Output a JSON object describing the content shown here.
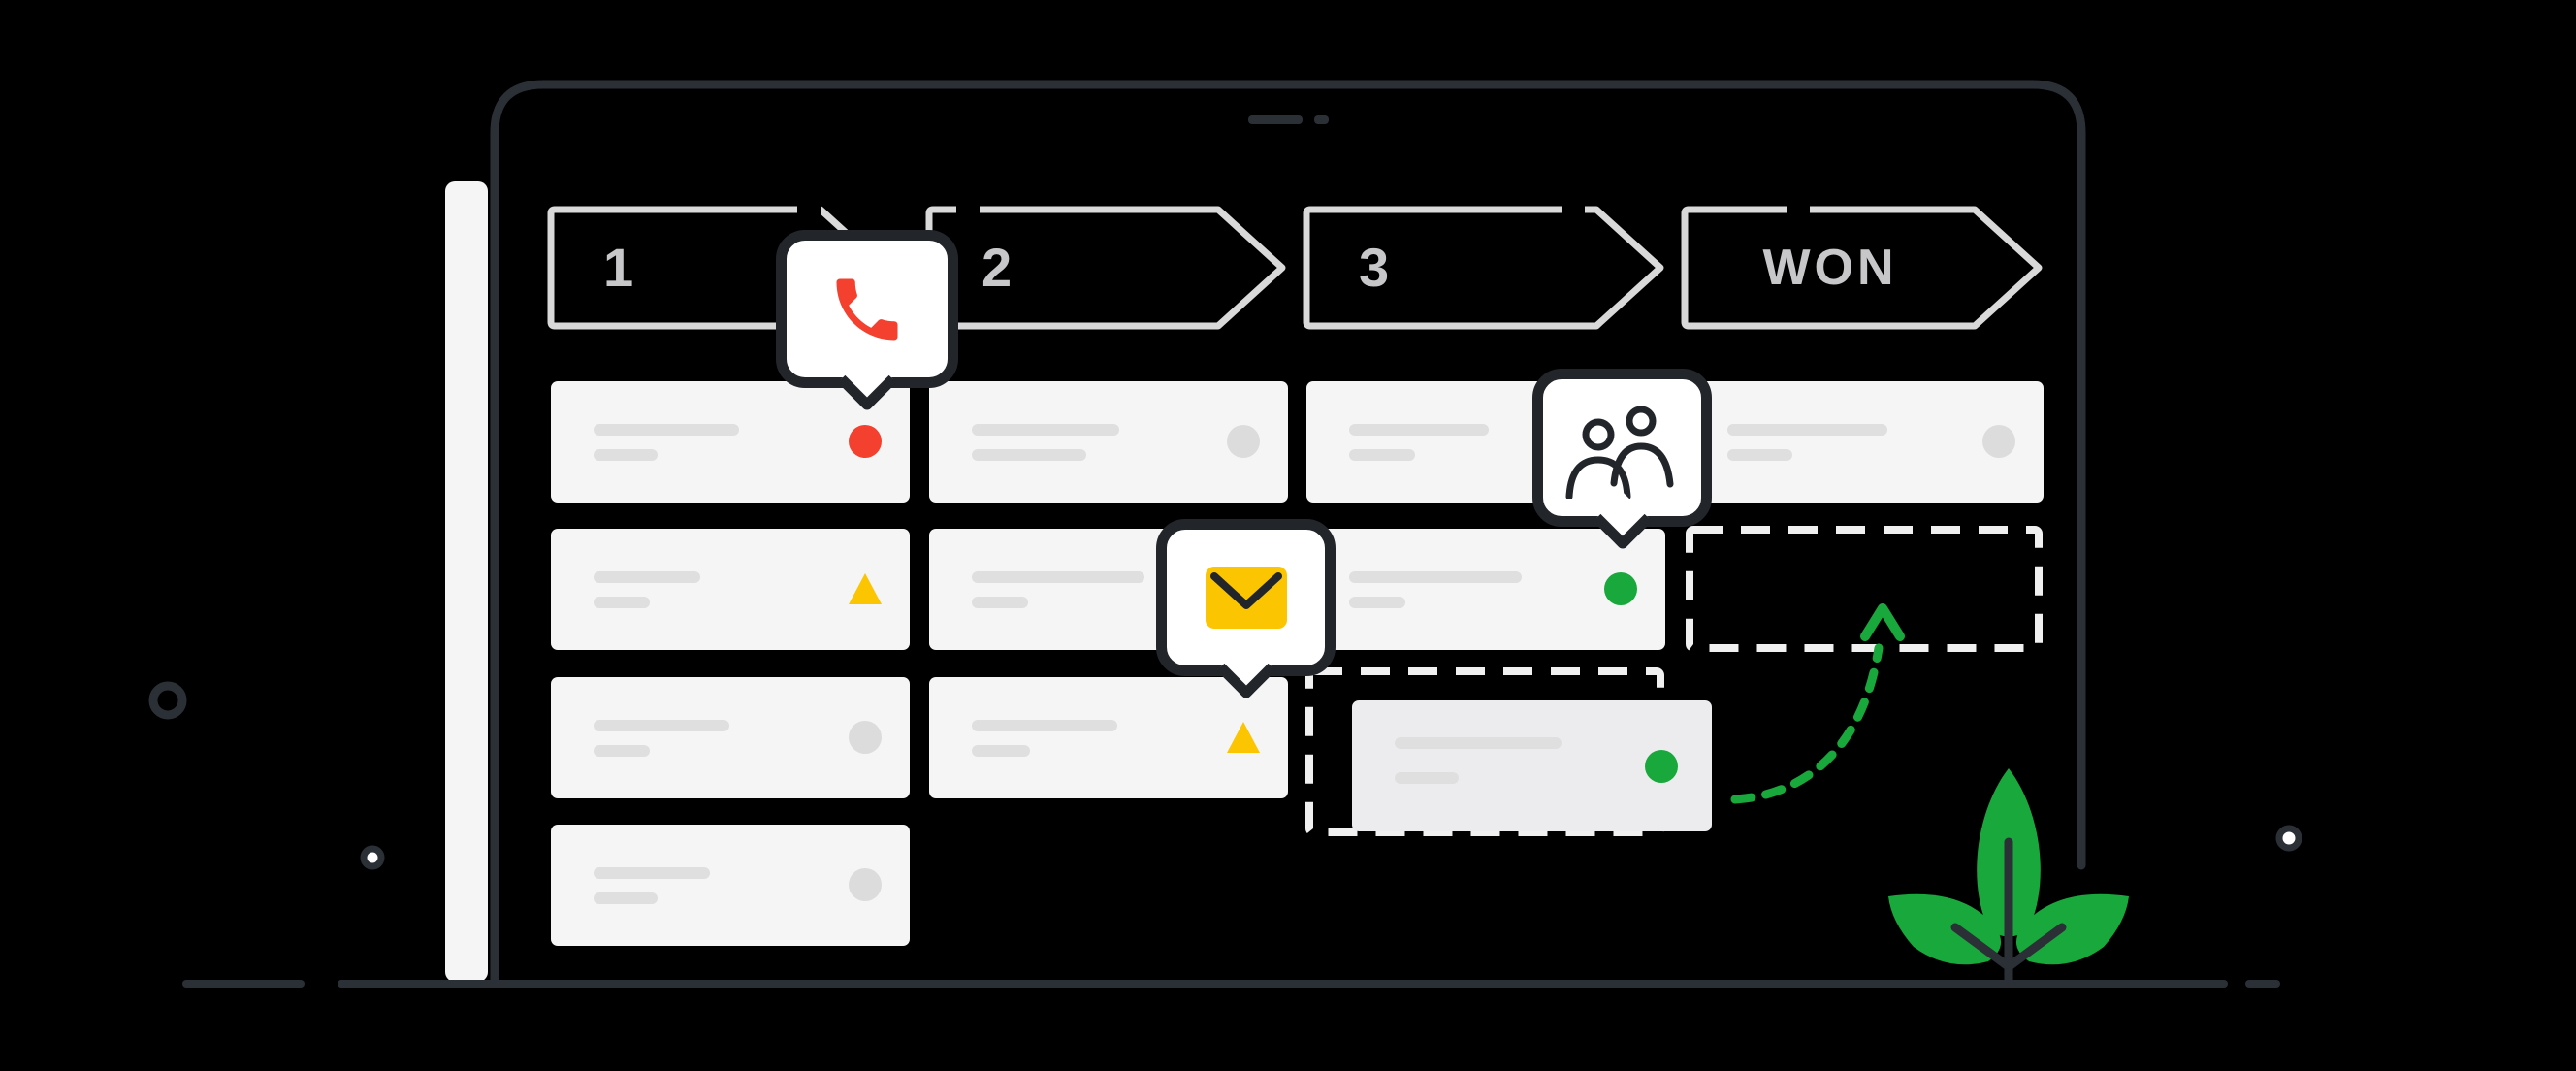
{
  "scene": {
    "description": "Sales pipeline kanban illustration on a laptop screen with a deal card being dragged to the WON stage"
  },
  "pipeline": {
    "stages": [
      {
        "label": "1"
      },
      {
        "label": "2"
      },
      {
        "label": "3"
      },
      {
        "label": "WON"
      }
    ]
  },
  "board": {
    "columns": [
      {
        "stage": "1",
        "cards": [
          {
            "row": 1,
            "indicator": "red-dot",
            "line1": 150,
            "line2": 66
          },
          {
            "row": 2,
            "indicator": "yellow-triangle",
            "line1": 110,
            "line2": 58
          },
          {
            "row": 3,
            "indicator": "gray-dot",
            "line1": 140,
            "line2": 58
          },
          {
            "row": 4,
            "indicator": "gray-dot",
            "line1": 120,
            "line2": 66
          }
        ]
      },
      {
        "stage": "2",
        "cards": [
          {
            "row": 1,
            "indicator": "gray-dot",
            "line1": 152,
            "line2": 118
          },
          {
            "row": 2,
            "indicator": "none",
            "line1": 178,
            "line2": 58
          },
          {
            "row": 3,
            "indicator": "yellow-triangle",
            "line1": 150,
            "line2": 60
          }
        ]
      },
      {
        "stage": "3",
        "cards": [
          {
            "row": 1,
            "indicator": "none",
            "line1": 144,
            "line2": 68
          },
          {
            "row": 2,
            "indicator": "green-dot",
            "line1": 178,
            "line2": 58
          }
        ]
      },
      {
        "stage": "WON",
        "cards": [
          {
            "row": 1,
            "indicator": "gray-dot",
            "line1": 165,
            "line2": 67
          }
        ]
      }
    ],
    "dragged_card": {
      "indicator": "green-dot",
      "line1": 172,
      "line2": 66
    }
  },
  "tooltips": [
    {
      "name": "call",
      "icon": "phone-icon"
    },
    {
      "name": "email",
      "icon": "envelope-icon"
    },
    {
      "name": "contacts",
      "icon": "people-icon"
    }
  ],
  "colors": {
    "background": "#000000",
    "frame_stroke": "#2b3036",
    "surface": "#f5f5f6",
    "stage_outline": "#d9d9d9",
    "stage_text": "#c7c7ca",
    "placeholder": "#dfdfe0",
    "indicator_gray": "#dcdcdd",
    "dashed_white": "#f0f0f0",
    "red": "#f4402e",
    "yellow": "#fcc502",
    "green": "#19a83b",
    "ink": "#22262b"
  }
}
